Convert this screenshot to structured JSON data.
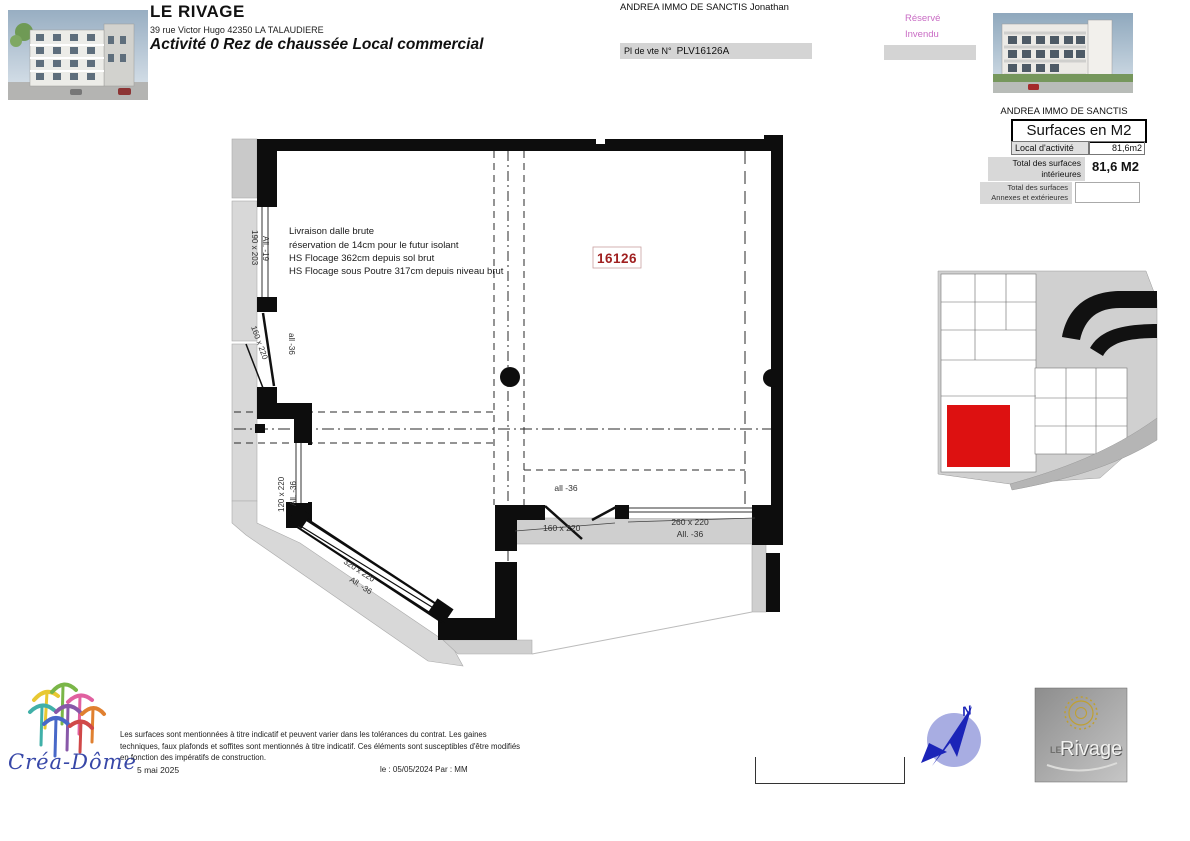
{
  "header": {
    "title": "LE RIVAGE",
    "address": "39 rue Victor Hugo  42350  LA TALAUDIERE",
    "subtitle": "Activité 0 Rez de chaussée Local commercial",
    "agent": "ANDREA IMMO DE SANCTIS Jonathan",
    "sale_plan_label": "Pl de vte N°",
    "sale_plan_number": "PLV16126A",
    "legend_reserved": "Réservé",
    "legend_unsold": "Invendu"
  },
  "surfaces_panel": {
    "company": "ANDREA IMMO DE SANCTIS",
    "title": "Surfaces en M2",
    "row_label": "Local d'activité",
    "row_value": "81,6m2",
    "total_label_line1": "Total des surfaces",
    "total_label_line2": "intérieures",
    "total_value": "81,6 M2",
    "annex_line1": "Total des surfaces",
    "annex_line2": "Annexes  et extérieures"
  },
  "plan": {
    "unit_number": "16126",
    "notes": {
      "line1": "Livraison dalle brute",
      "line2": "réservation de 14cm pour le futur isolant",
      "line3": "HS Flocage 362cm depuis sol brut",
      "line4": "HS Flocage sous Poutre 317cm depuis niveau brut"
    },
    "labels": {
      "window_left_top": "190 x 203",
      "window_left_top_allege": "All. -19",
      "door_left": "160 x 220",
      "door_left_allege": "all -36",
      "window_left_bottom": "120 x 220",
      "window_left_bottom_allege": "All. -36",
      "window_diagonal": "320 x 220",
      "window_diagonal_allege": "All. -36",
      "opening_bottom_allege": "all -36",
      "door_bottom": "160 x 220",
      "window_bottom": "260 x 220",
      "window_bottom_allege": "All. -36"
    }
  },
  "footer": {
    "logo_text": "Créa-Dôme",
    "disclaimer_line1": "Les surfaces sont mentionnées à titre indicatif et peuvent varier dans les tolérances du contrat. Les gaines",
    "disclaimer_line2": "techniques, faux plafonds et soffites sont mentionnés à titre indicatif. Ces éléments sont susceptibles d'être modifiés",
    "disclaimer_line3": "en fonction des impératifs de construction.",
    "date": "5 mai 2025",
    "revision": "le : 05/05/2024  Par : MM",
    "compass_north": "N",
    "brand_small": "LE",
    "brand_main": "Rivage"
  },
  "colors": {
    "legend_pink": "#c96cc4",
    "unit_number_red": "#a02020",
    "keyplan_highlight_red": "#dd1111"
  }
}
